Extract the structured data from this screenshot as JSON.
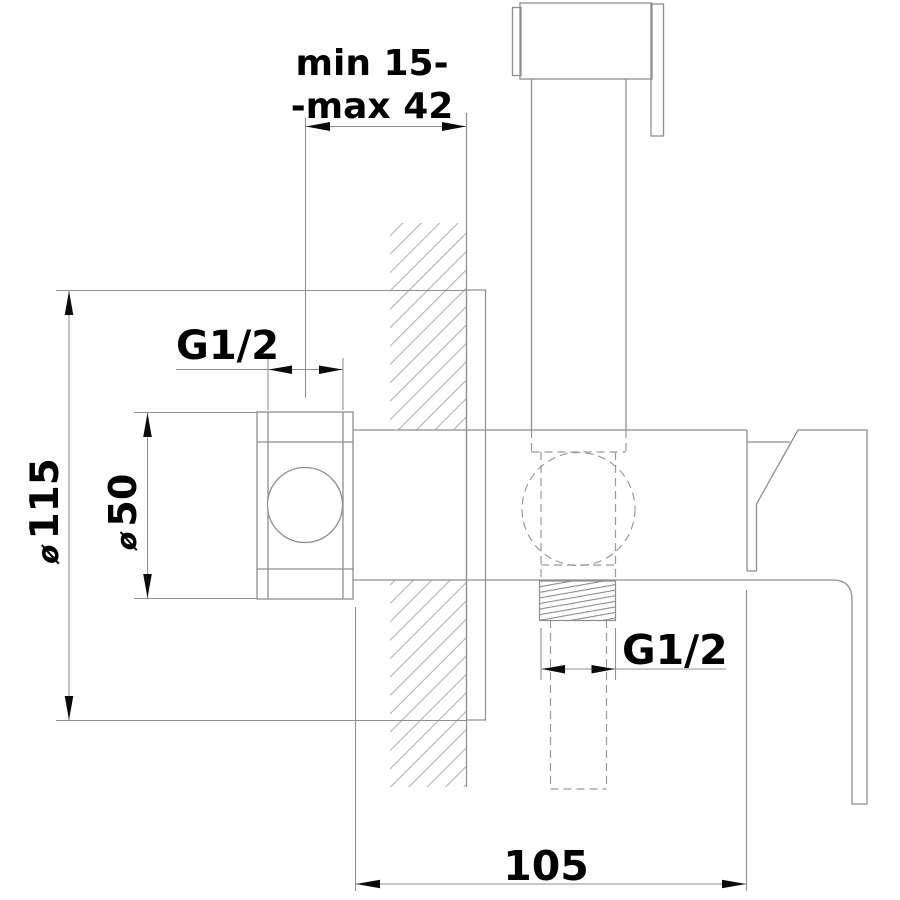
{
  "drawing": {
    "type": "technical installation drawing, concealed bidet hand-shower mixer, side section view",
    "labels": {
      "depth_range_line1": "min 15-",
      "depth_range_line2": "-max 42",
      "thread_top": "G1/2",
      "thread_bottom": "G1/2",
      "plate_diameter_symbol": "ø",
      "plate_diameter_value": "115",
      "valve_diameter_symbol": "ø",
      "valve_diameter_value": "50",
      "body_length_value": "105"
    },
    "dimensions": [
      {
        "name": "wall mounting depth range",
        "value": "min 15 - max 42"
      },
      {
        "name": "wall plate diameter",
        "value": "ø 115"
      },
      {
        "name": "stop valve rosette diameter",
        "value": "ø 50"
      },
      {
        "name": "top connection thread",
        "value": "G1/2"
      },
      {
        "name": "bottom outlet thread",
        "value": "G1/2"
      },
      {
        "name": "body length",
        "value": "105"
      }
    ],
    "colors": {
      "line": "#8f8f8f",
      "hatch": "#b3b3b3",
      "thread_hatch": "#8c8c8c",
      "arrow": "#0a0a0a",
      "text": "#000000",
      "background": "#ffffff"
    }
  }
}
